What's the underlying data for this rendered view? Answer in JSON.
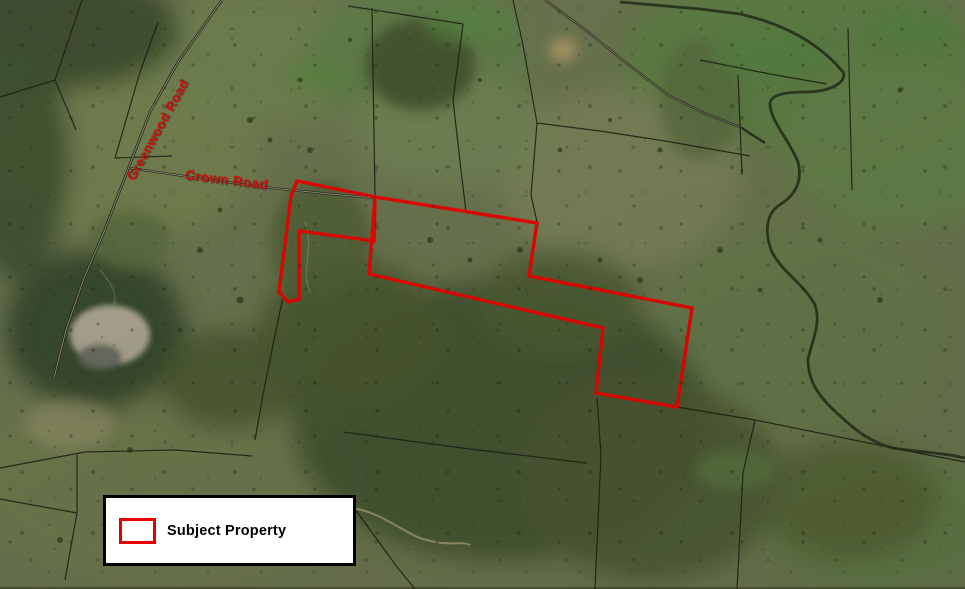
{
  "map": {
    "road_labels": [
      {
        "id": "greenwood-road",
        "text": "Greenwood Road",
        "color": "#d01010"
      },
      {
        "id": "crown-road",
        "text": "Crown Road",
        "color": "#d01010"
      }
    ],
    "boundary": {
      "name": "Subject Property",
      "color": "#e80000",
      "west_parcel_points": "297,181 375,197 374,241 299,231 299,299 288,302 279,292 291,196",
      "east_parcel_points": "375,197 537,223 529,276 692,308 677,407 596,393 603,328 369,274"
    }
  },
  "legend": {
    "items": [
      {
        "label": "Subject Property",
        "swatch_color": "#e80000"
      }
    ]
  }
}
